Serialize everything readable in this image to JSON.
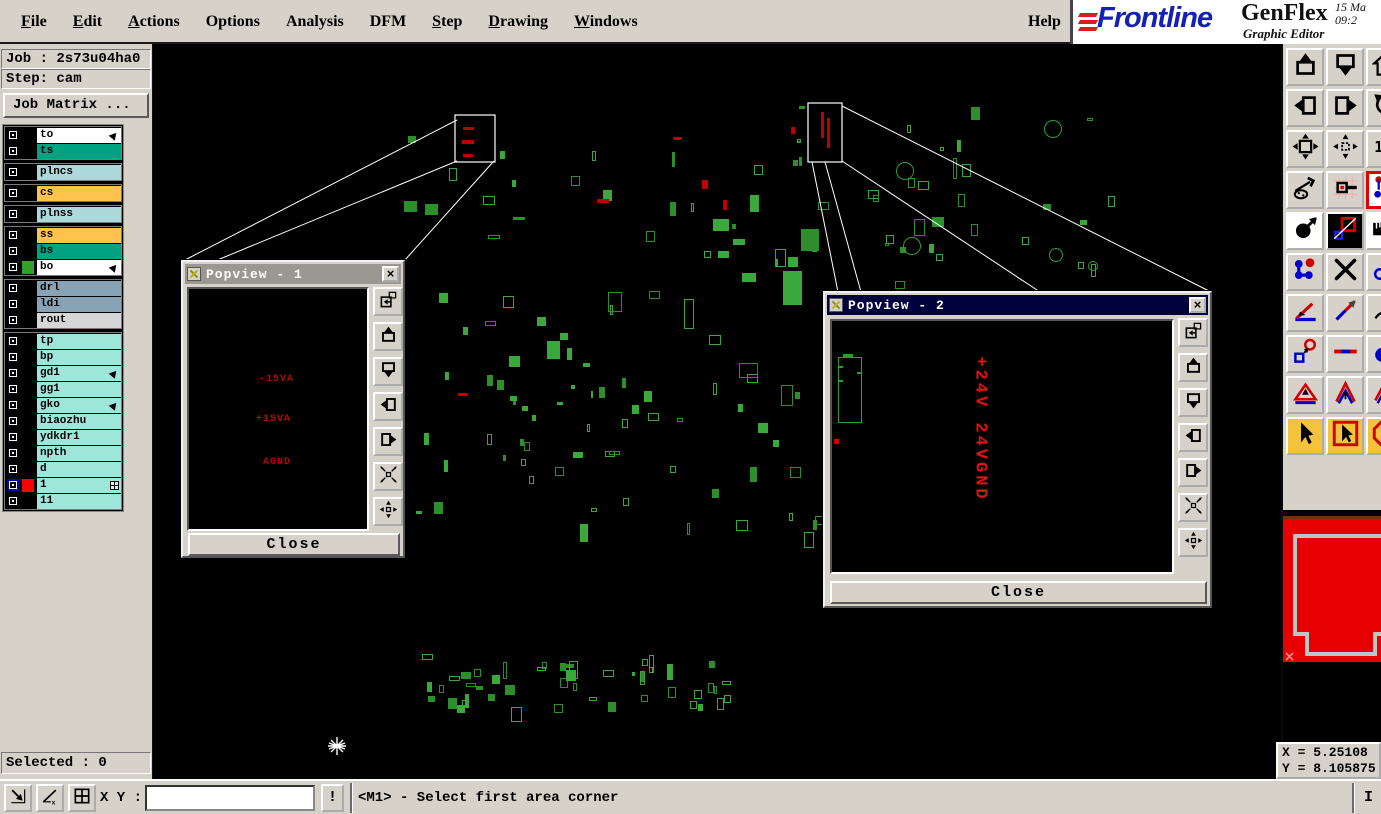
{
  "menu": {
    "items": [
      {
        "label": "File",
        "underline": true
      },
      {
        "label": "Edit",
        "underline": true
      },
      {
        "label": "Actions",
        "underline": true
      },
      {
        "label": "Options",
        "underline": false
      },
      {
        "label": "Analysis",
        "underline": false
      },
      {
        "label": "DFM",
        "underline": false
      },
      {
        "label": "Step",
        "underline": true
      },
      {
        "label": "Drawing",
        "underline": true
      },
      {
        "label": "Windows",
        "underline": true
      }
    ],
    "help": {
      "label": "Help"
    }
  },
  "brand": {
    "logo_text": "Frontline",
    "product": "GenFlex",
    "subtitle": "Graphic Editor",
    "date_fragment": "15 Ma",
    "time_fragment": "09:2"
  },
  "job_panel": {
    "job": "Job : 2s73u04ha0",
    "step": "Step: cam",
    "matrix_button": "Job Matrix ..."
  },
  "layers": {
    "groups": [
      {
        "items": [
          {
            "name": "to",
            "bg": "#ffffff",
            "marker": "arrow"
          },
          {
            "name": "ts",
            "bg": "#00a381"
          }
        ]
      },
      {
        "items": [
          {
            "name": "plncs",
            "bg": "#acd8dc"
          }
        ]
      },
      {
        "items": [
          {
            "name": "cs",
            "bg": "#ffc34d"
          }
        ]
      },
      {
        "items": [
          {
            "name": "plnss",
            "bg": "#acd8dc"
          }
        ]
      },
      {
        "items": [
          {
            "name": "ss",
            "bg": "#ffc34d"
          },
          {
            "name": "bs",
            "bg": "#00a381"
          },
          {
            "name": "bo",
            "bg": "#ffffff",
            "swatch": "#33a02c",
            "marker": "arrow"
          }
        ]
      },
      {
        "items": [
          {
            "name": "drl",
            "bg": "#87a3b5"
          },
          {
            "name": "ldi",
            "bg": "#87a3b5"
          },
          {
            "name": "rout",
            "bg": "#d6d6d6"
          }
        ]
      },
      {
        "items": [
          {
            "name": "tp",
            "bg": "#9fe6da"
          },
          {
            "name": "bp",
            "bg": "#9fe6da"
          },
          {
            "name": "gd1",
            "bg": "#9fe6da",
            "marker": "arrow"
          },
          {
            "name": "gg1",
            "bg": "#9fe6da"
          },
          {
            "name": "gko",
            "bg": "#9fe6da",
            "marker": "arrow"
          },
          {
            "name": "biaozhu",
            "bg": "#9fe6da"
          },
          {
            "name": "ydkdr1",
            "bg": "#9fe6da"
          },
          {
            "name": "npth",
            "bg": "#9fe6da"
          },
          {
            "name": "d",
            "bg": "#9fe6da"
          },
          {
            "name": "1",
            "bg": "#9fe6da",
            "swatch": "#ff0000",
            "active": true,
            "marker": "grid"
          },
          {
            "name": "11",
            "bg": "#9fe6da"
          }
        ]
      }
    ]
  },
  "popview1": {
    "title": "Popview - 1",
    "labels": [
      "-15VA",
      "+15VA",
      "AGND"
    ],
    "close": "Close"
  },
  "popview2": {
    "title": "Popview - 2",
    "vertical_label": "+24V 24VGND",
    "close": "Close"
  },
  "popview_buttons": [
    {
      "name": "copy-view",
      "icon": "win-copy"
    },
    {
      "name": "pan-up",
      "icon": "pan-up"
    },
    {
      "name": "pan-down",
      "icon": "pan-down"
    },
    {
      "name": "pan-left",
      "icon": "pan-left"
    },
    {
      "name": "pan-right",
      "icon": "pan-right"
    },
    {
      "name": "center-view",
      "icon": "arrows-in-diag"
    },
    {
      "name": "expand-view",
      "icon": "arrows-out-plus"
    }
  ],
  "toolbar_right": {
    "buttons": [
      {
        "name": "pan-view-up",
        "icon": "pan-up"
      },
      {
        "name": "pan-view-down",
        "icon": "pan-down"
      },
      {
        "name": "home-view",
        "icon": "home"
      },
      {
        "name": "pan-view-left",
        "icon": "pan-left"
      },
      {
        "name": "pan-view-right",
        "icon": "pan-right"
      },
      {
        "name": "rotate-view",
        "icon": "rotate-left"
      },
      {
        "name": "zoom-out",
        "icon": "arrows-out"
      },
      {
        "name": "zoom-in",
        "icon": "arrows-out-small"
      },
      {
        "name": "zoom-one-to-one",
        "icon": "one-to-one"
      },
      {
        "name": "setup-tools",
        "icon": "tools"
      },
      {
        "name": "snap-grid",
        "icon": "snap-grid"
      },
      {
        "name": "highlight-net",
        "icon": "net-highlight",
        "style": "selected"
      },
      {
        "name": "select-circle",
        "icon": "circle-arrow",
        "style": "white"
      },
      {
        "name": "area-zoom",
        "icon": "area-dark",
        "style": "dark"
      },
      {
        "name": "measure-ruler",
        "icon": "ruler",
        "style": "white"
      },
      {
        "name": "net-connect",
        "icon": "net-dots"
      },
      {
        "name": "delete-object",
        "icon": "delete-x"
      },
      {
        "name": "move-object",
        "icon": "circle-link"
      },
      {
        "name": "measure-angle",
        "icon": "angle-measure"
      },
      {
        "name": "measure-distance",
        "icon": "measure-line"
      },
      {
        "name": "reroute",
        "icon": "curve-arrow"
      },
      {
        "name": "origin-marker",
        "icon": "circle-square"
      },
      {
        "name": "segment-tool",
        "icon": "segment"
      },
      {
        "name": "fill-tool",
        "icon": "circle-fill-tool"
      },
      {
        "name": "triangle-marker",
        "icon": "triangle-up"
      },
      {
        "name": "chevron-marker",
        "icon": "chevron-up"
      },
      {
        "name": "chevron-flat-marker",
        "icon": "chevron-flat"
      },
      {
        "name": "select-mode",
        "icon": "cursor",
        "style": "yellow"
      },
      {
        "name": "select-frame-mode",
        "icon": "cursor-box",
        "style": "yellow"
      },
      {
        "name": "select-stop-mode",
        "icon": "cursor-oct",
        "style": "yellow"
      }
    ]
  },
  "status_bar": {
    "selected": "Selected : 0",
    "xy_label": "X Y :",
    "xy_value": "",
    "alert": "!",
    "prompt": "<M1> - Select first area corner",
    "right_indicator": "I"
  },
  "coords": {
    "x": "X = 5.25108",
    "y": "Y = 8.105875"
  },
  "colors": {
    "pcb_green": "#2f9e2f",
    "net_red": "#e21212",
    "board_preview_red": "#e80000",
    "active_layer_red": "#ff0000"
  }
}
